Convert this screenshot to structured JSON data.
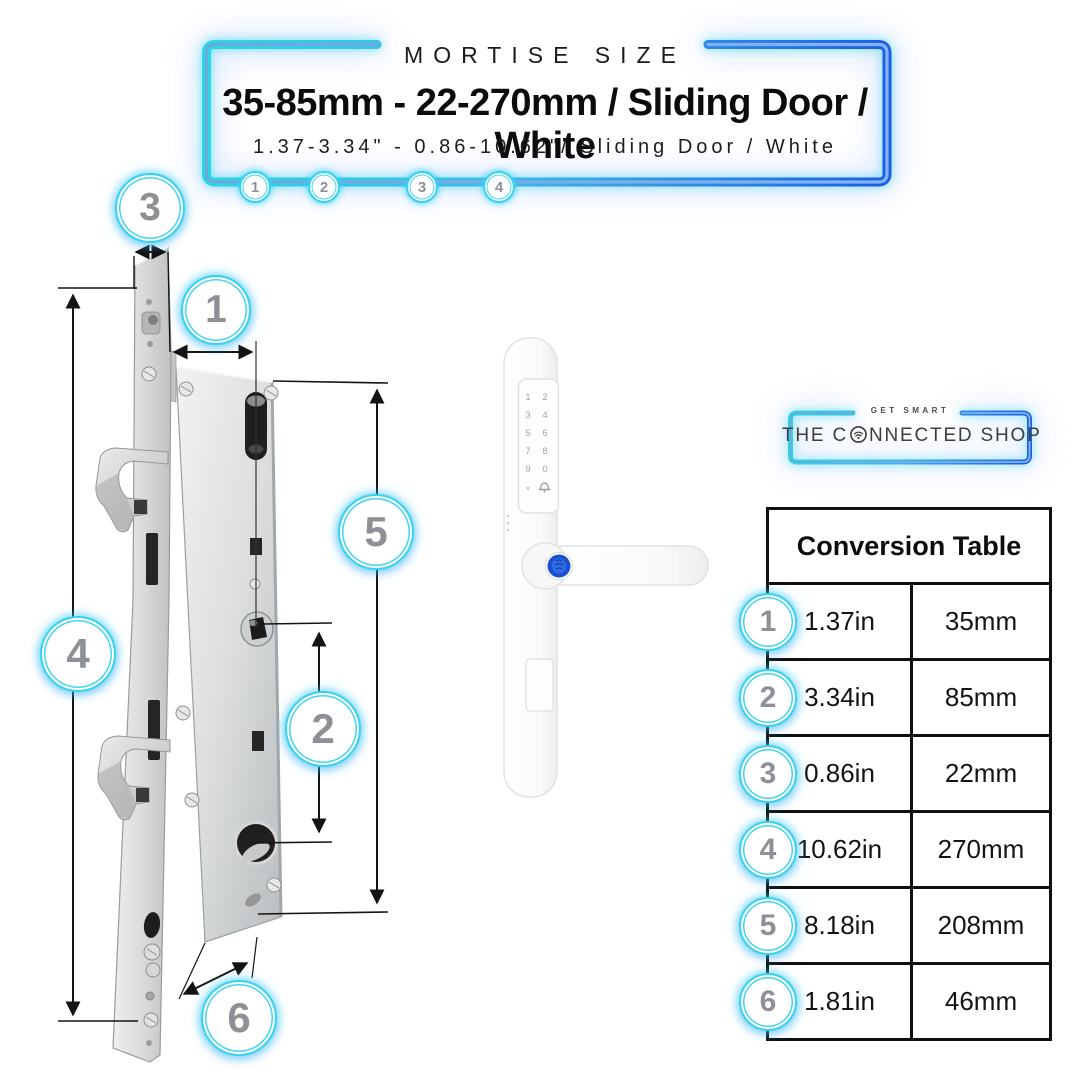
{
  "header": {
    "eyebrow": "MORTISE SIZE",
    "title": "35-85mm - 22-270mm / Sliding Door / White",
    "subtitle": "1.37-3.34\" - 0.86-10.62\"/ Sliding Door / White",
    "step_badges": [
      "1",
      "2",
      "3",
      "4"
    ]
  },
  "logo": {
    "tagline": "GET SMART",
    "brand_prefix": "THE C",
    "brand_suffix": "NNECTED SHOP",
    "icon": "wifi-o-icon"
  },
  "diagram": {
    "description": "mortise lock body with dimension callouts",
    "badges": {
      "b1": "1",
      "b2": "2",
      "b3": "3",
      "b4": "4",
      "b5": "5",
      "b6": "6"
    }
  },
  "product": {
    "description": "white smart sliding-door handle with keypad and fingerprint sensor",
    "keypad_keys": [
      "1",
      "2",
      "3",
      "4",
      "5",
      "6",
      "7",
      "8",
      "9",
      "0",
      "*"
    ],
    "bell_icon": "bell-icon",
    "fingerprint_icon": "fingerprint-sensor"
  },
  "conversion_table": {
    "title": "Conversion Table",
    "rows": [
      {
        "num": "1",
        "inches": "1.37in",
        "mm": "35mm"
      },
      {
        "num": "2",
        "inches": "3.34in",
        "mm": "85mm"
      },
      {
        "num": "3",
        "inches": "0.86in",
        "mm": "22mm"
      },
      {
        "num": "4",
        "inches": "10.62in",
        "mm": "270mm"
      },
      {
        "num": "5",
        "inches": "8.18in",
        "mm": "208mm"
      },
      {
        "num": "6",
        "inches": "1.81in",
        "mm": "46mm"
      }
    ]
  },
  "colors": {
    "neon_cyan": "#2dd4ea",
    "neon_blue": "#2563eb",
    "badge_ring": "#38d2f0",
    "number_gray": "#8d9094",
    "fingerprint_blue": "#2e6ae0",
    "table_border": "#101010"
  }
}
